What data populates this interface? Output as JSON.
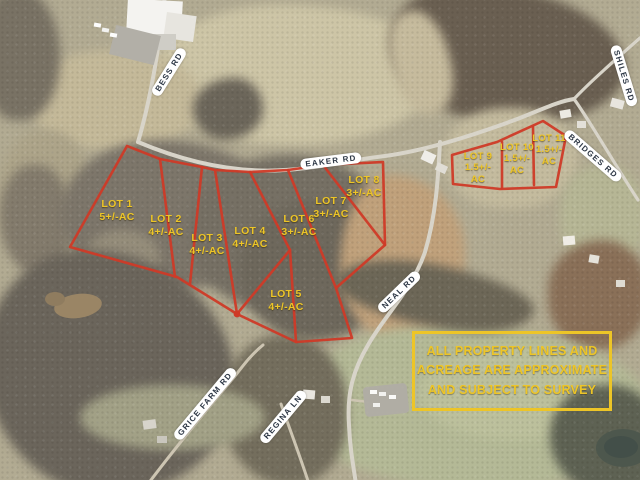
{
  "lots": [
    {
      "name": "LOT 1",
      "acreage": "5+/-AC"
    },
    {
      "name": "LOT 2",
      "acreage": "4+/-AC"
    },
    {
      "name": "LOT 3",
      "acreage": "4+/-AC"
    },
    {
      "name": "LOT 4",
      "acreage": "4+/-AC"
    },
    {
      "name": "LOT 5",
      "acreage": "4+/-AC"
    },
    {
      "name": "LOT 6",
      "acreage": "3+/-AC"
    },
    {
      "name": "LOT 7",
      "acreage": "3+/-AC"
    },
    {
      "name": "LOT 8",
      "acreage": "3+/-AC"
    },
    {
      "name": "LOT 9",
      "acreage": "1.5+/- AC"
    },
    {
      "name": "LOT 10",
      "acreage": "1.5+/- AC"
    },
    {
      "name": "LOT 11",
      "acreage": "1.5+/- AC"
    }
  ],
  "road_labels": [
    {
      "label": "BESS RD"
    },
    {
      "label": "EAKER RD"
    },
    {
      "label": "SHILES RD"
    },
    {
      "label": "BRIDGES RD"
    },
    {
      "label": "NEAL RD"
    },
    {
      "label": "GRICE FARM RD"
    },
    {
      "label": "REGINA LN"
    }
  ],
  "disclaimer": {
    "line1": "ALL PROPERTY LINES AND",
    "line2": "ACREAGE ARE APPROXIMATE",
    "line3": "AND SUBJECT TO SURVEY"
  },
  "colors": {
    "parcel_line": "#cf3a27",
    "lot_label_text": "#edc527",
    "disclaimer_text": "#edc527",
    "road_label_bg": "#ffffff",
    "road_label_text": "#2c3644"
  }
}
